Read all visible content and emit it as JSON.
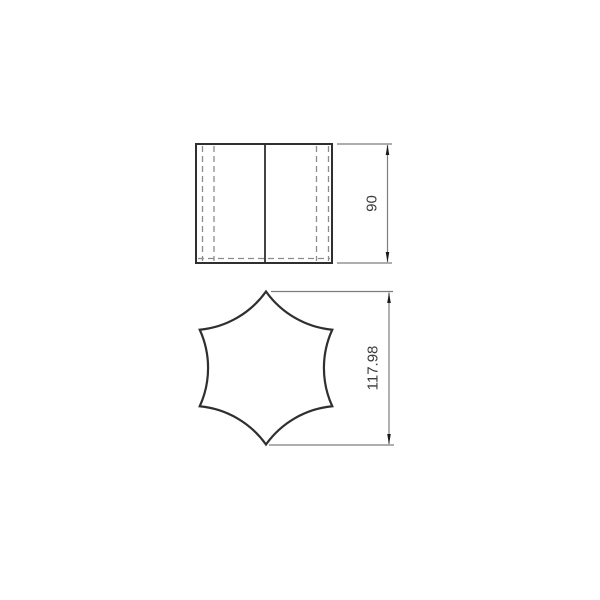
{
  "drawing": {
    "kind": "technical-drawing",
    "dimensions": {
      "front_height": {
        "label": "90"
      },
      "profile_height": {
        "label": "117.98"
      }
    },
    "colors": {
      "solid_line": "#2f2f2f",
      "hidden_line": "#8c8c8c",
      "dimension_line": "#7d7d7d",
      "arrow": "#1a1a1a",
      "text": "#3a3a3a",
      "background": "#ffffff"
    }
  }
}
